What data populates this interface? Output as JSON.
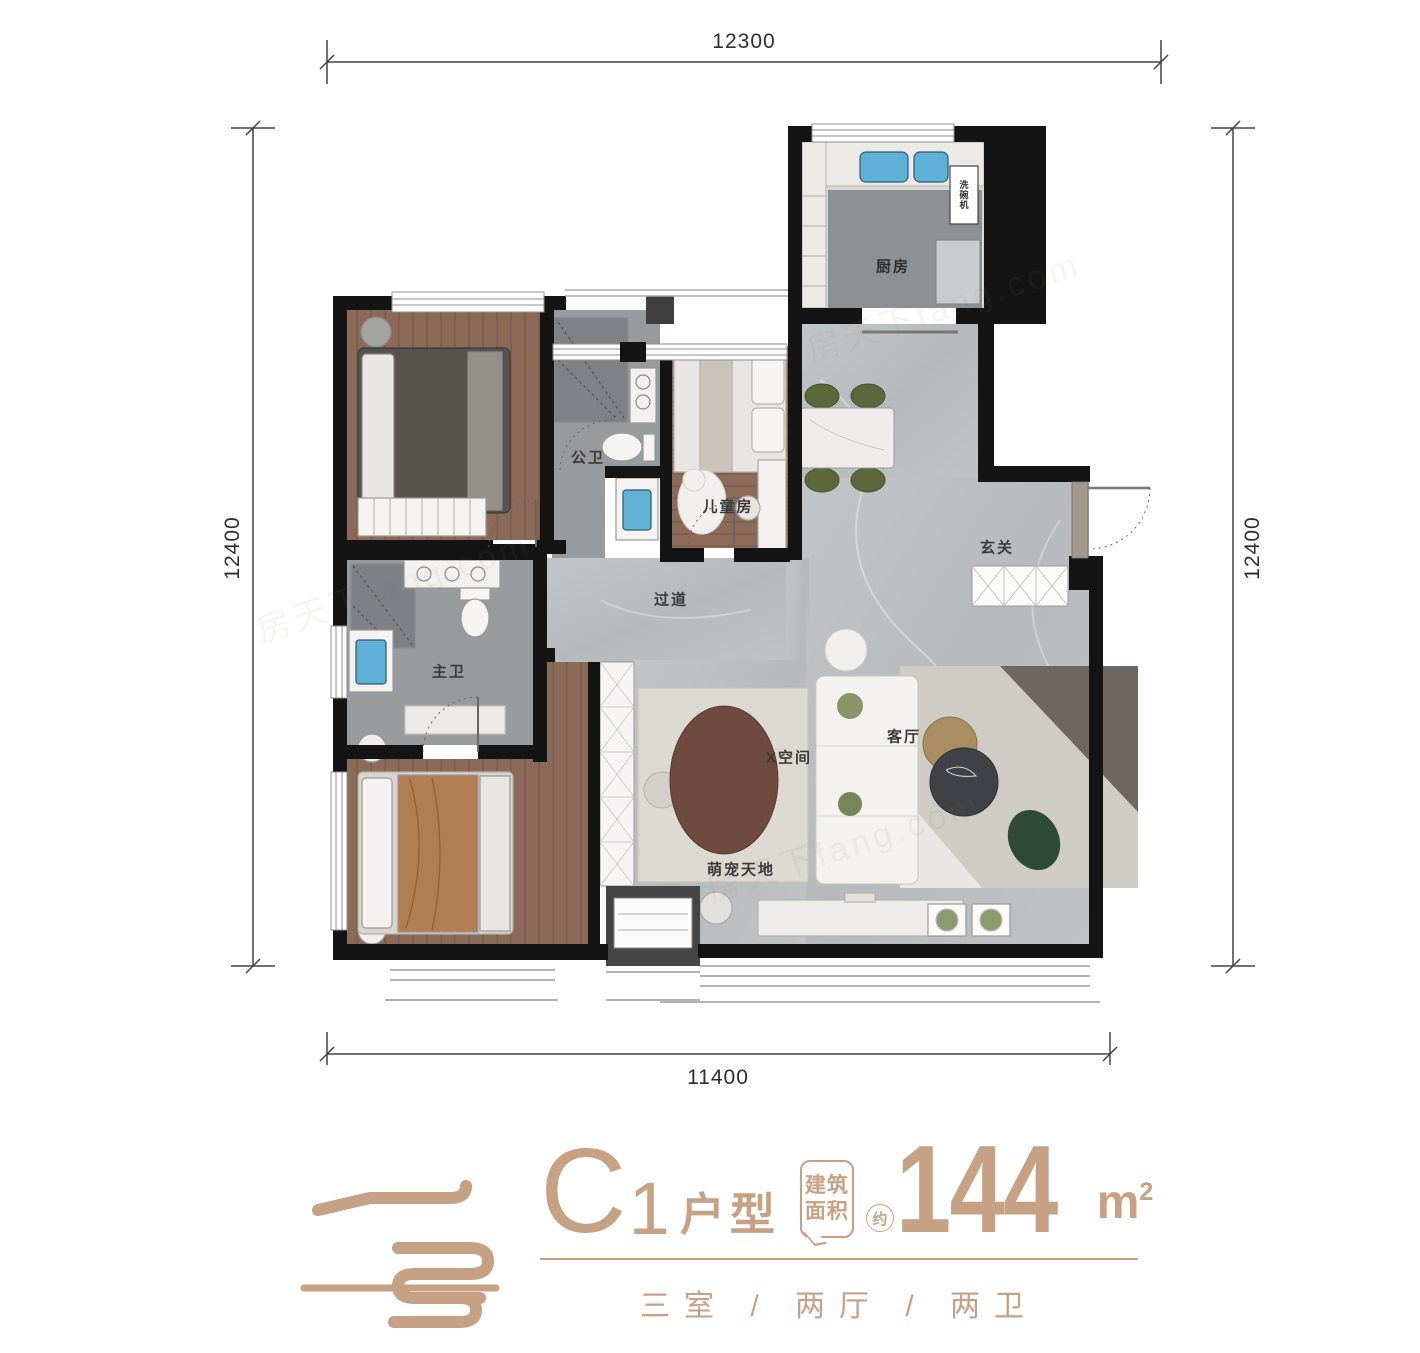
{
  "accent_color": "#C6A183",
  "watermark": "房天下fang.com",
  "dimensions": {
    "top": "12300",
    "bottom": "11400",
    "left": "12400",
    "right": "12400"
  },
  "rooms": {
    "kitchen": "厨房",
    "dishwasher": "洗碗机",
    "bath_public": "公卫",
    "kids_room": "儿童房",
    "foyer": "玄关",
    "corridor": "过道",
    "bath_master": "主卫",
    "x_space": "X空间",
    "living": "客厅",
    "pet_area": "萌宠天地"
  },
  "title": {
    "unit_letter": "C",
    "unit_number": "1",
    "unit_suffix": "户型",
    "bubble_line1": "建筑",
    "bubble_line2": "面积",
    "approx": "约",
    "area_value": "144",
    "area_unit": "m",
    "area_unit_exp": "2",
    "subtitle": "三室 / 两厅 / 两卫"
  }
}
